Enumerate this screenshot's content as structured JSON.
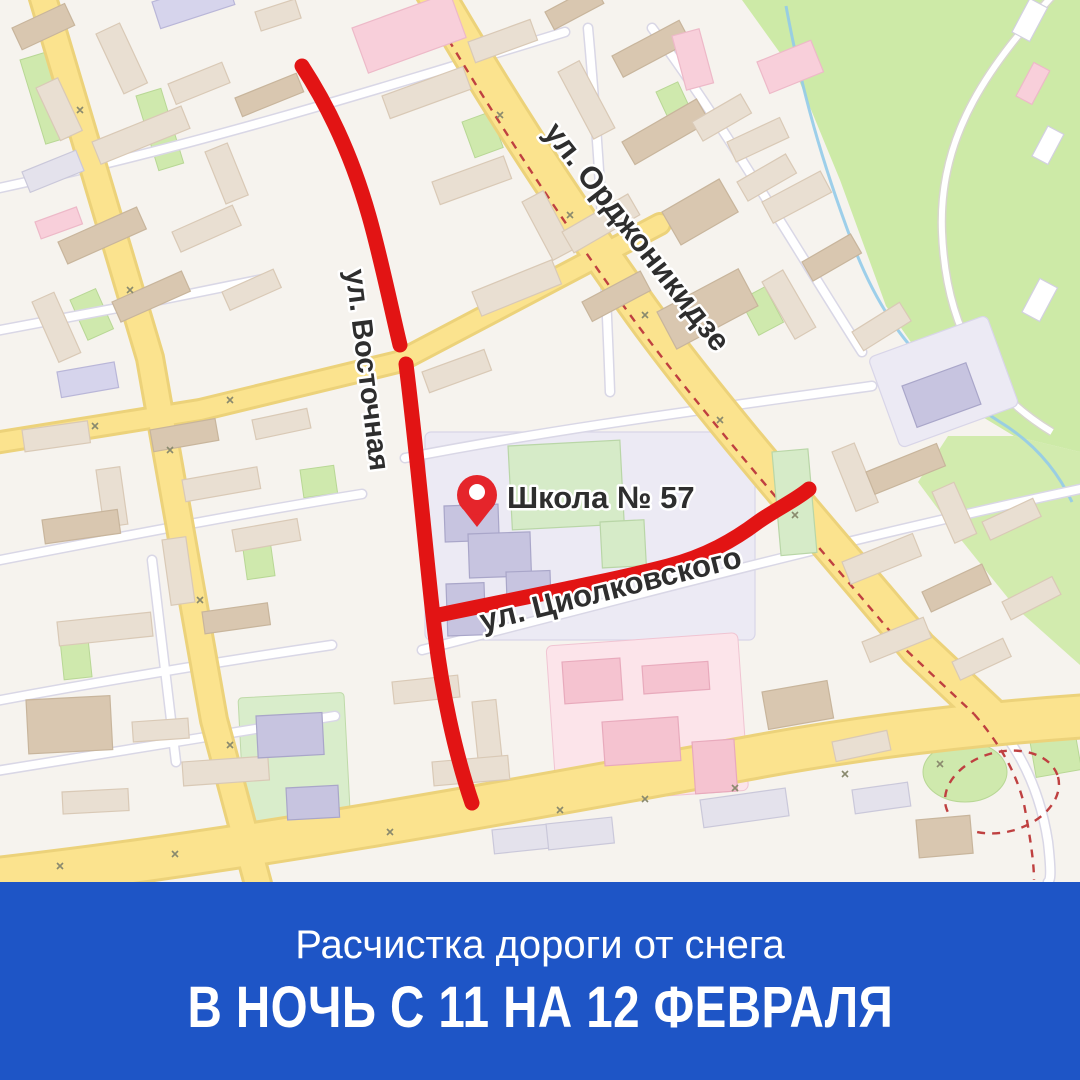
{
  "map": {
    "streets": [
      {
        "id": "ordzhonikidze",
        "label": "ул. Орджоникидзе"
      },
      {
        "id": "vostochnaya",
        "label": "ул. Восточная"
      },
      {
        "id": "tsiolkovskogo",
        "label": "ул. Циолковского"
      }
    ],
    "poi": {
      "school_label": "Школа № 57",
      "pin_icon": "map-pin-icon"
    }
  },
  "banner": {
    "subtitle": "Расчистка дороги от снега",
    "title": "В НОЧЬ С 11 НА 12 ФЕВРАЛЯ"
  },
  "colors": {
    "banner_blue": "#1e55c6",
    "route_red": "#e21414",
    "pin_red": "#e5252b",
    "road_yellow": "#fbe38e",
    "park_green": "#cdeaa7",
    "label_text": "#2e2e2e",
    "banner_text": "#ffffff"
  }
}
